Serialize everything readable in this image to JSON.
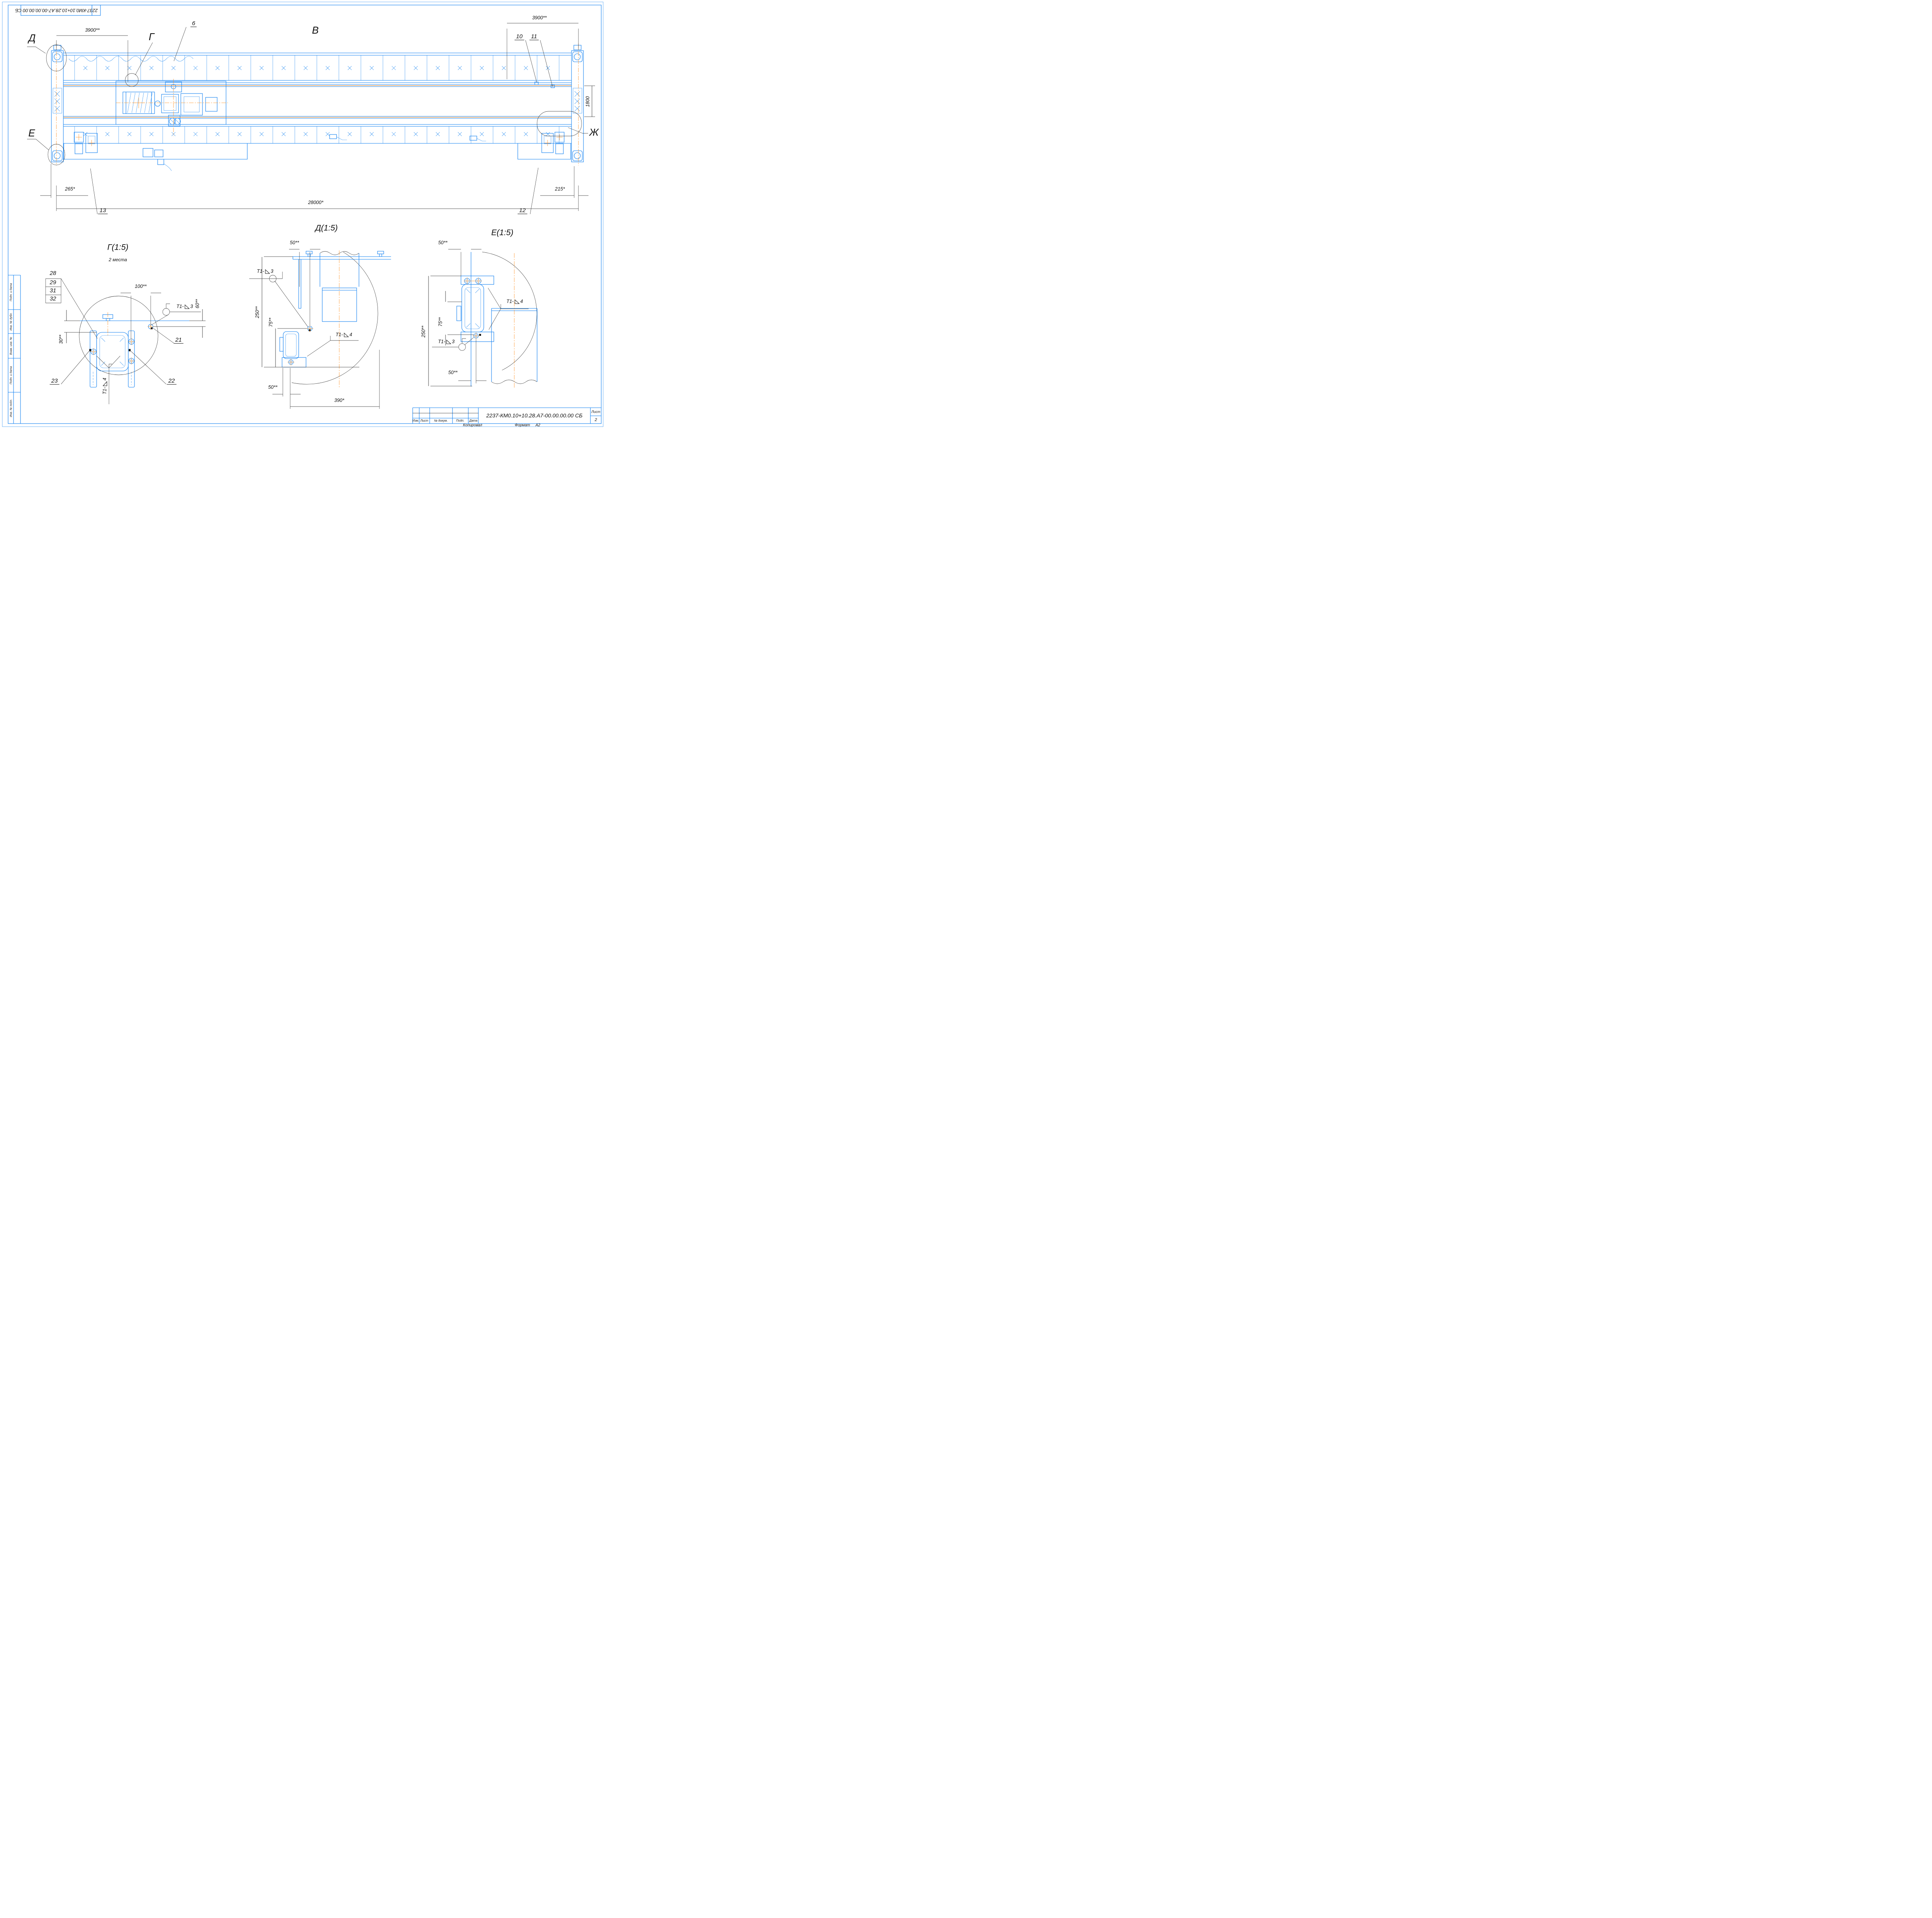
{
  "sheet": {
    "stamp_top": "2237-КМ0.10+10.28.А7-00.00.00.00 СБ",
    "colors": {
      "line_blue": "#0e7ff0",
      "line_orange": "#ff8c1a",
      "line_black": "#1c1c1c"
    }
  },
  "main_view": {
    "label": "В",
    "view_labels": {
      "d": "Д",
      "g": "Г",
      "e": "Е",
      "zh": "Ж"
    },
    "callouts": {
      "c6": "6",
      "c10": "10",
      "c11": "11",
      "c12": "12",
      "c13": "13"
    },
    "dims": {
      "span_left": "3900**",
      "span_right": "3900**",
      "gauge": "1800",
      "offset_left": "265*",
      "offset_right": "215*",
      "total": "28000*"
    }
  },
  "detail_g": {
    "title": "Г(1:5)",
    "note": "2 места",
    "stack": [
      "28",
      "29",
      "31",
      "32"
    ],
    "dims": {
      "d100": "100**",
      "d60": "60**",
      "d30": "30**"
    },
    "callouts": {
      "c21": "21",
      "c22": "22",
      "c23": "23"
    }
  },
  "detail_d": {
    "title": "Д(1:5)",
    "dims": {
      "top": "50**",
      "height": "250**",
      "offset": "75**",
      "bottom": "50**",
      "base": "390*"
    }
  },
  "detail_e": {
    "title": "Е(1:5)",
    "dims": {
      "top": "50**",
      "offset": "75**",
      "height": "250**",
      "bottom": "50**"
    }
  },
  "weld": {
    "prefix": "Т1-",
    "grade3": "3",
    "grade4": "4"
  },
  "title_block": {
    "doc_number": "2237-КМ0.10+10.28.А7-00.00.00.00 СБ",
    "headers": [
      "Изм.",
      "Лист",
      "№ докум.",
      "Подп.",
      "Дата"
    ],
    "sheet_label": "Лист",
    "sheet_number": "2",
    "footer_copy": "Копировал",
    "footer_format_label": "Формат",
    "footer_format_value": "А2"
  },
  "sidebar": {
    "items": [
      "Подп. и дата",
      "Инв. № дубл.",
      "Взам. инв. №",
      "Подп. и дата",
      "Инв. № подл."
    ]
  }
}
